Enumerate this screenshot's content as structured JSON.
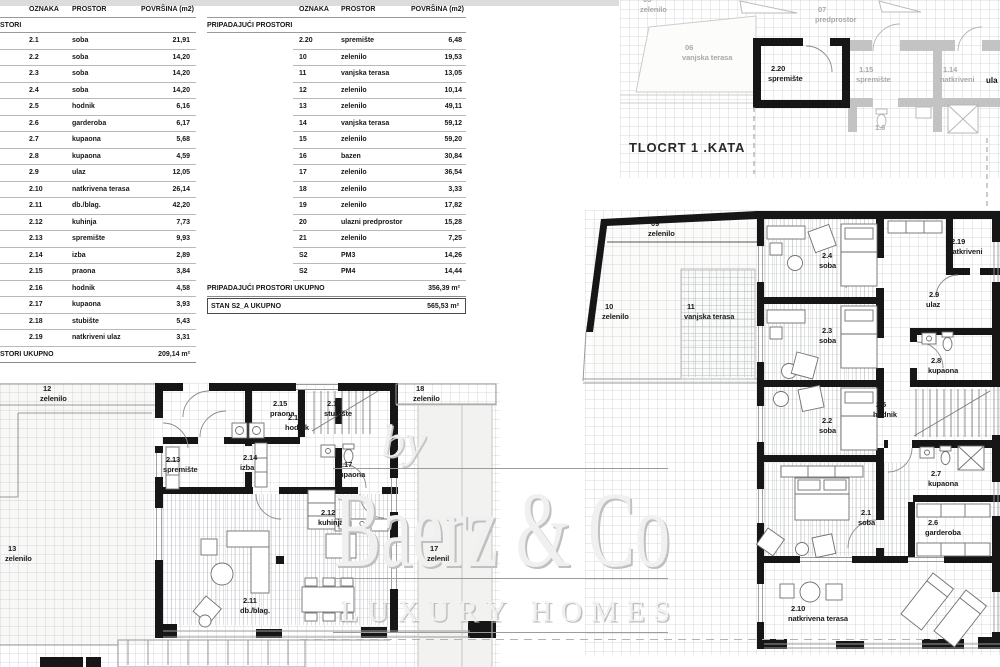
{
  "tables": {
    "columns": [
      "OZNAKA",
      "PROSTOR",
      "POVRŠINA (m2)"
    ],
    "table1": {
      "section": "STORI",
      "rows": [
        {
          "oznaka": "2.1",
          "prostor": "soba",
          "povrsina": "21,91"
        },
        {
          "oznaka": "2.2",
          "prostor": "soba",
          "povrsina": "14,20"
        },
        {
          "oznaka": "2.3",
          "prostor": "soba",
          "povrsina": "14,20"
        },
        {
          "oznaka": "2.4",
          "prostor": "soba",
          "povrsina": "14,20"
        },
        {
          "oznaka": "2.5",
          "prostor": "hodnik",
          "povrsina": "6,16"
        },
        {
          "oznaka": "2.6",
          "prostor": "garderoba",
          "povrsina": "6,17"
        },
        {
          "oznaka": "2.7",
          "prostor": "kupaona",
          "povrsina": "5,68"
        },
        {
          "oznaka": "2.8",
          "prostor": "kupaona",
          "povrsina": "4,59"
        },
        {
          "oznaka": "2.9",
          "prostor": "ulaz",
          "povrsina": "12,05"
        },
        {
          "oznaka": "2.10",
          "prostor": "natkrivena terasa",
          "povrsina": "26,14"
        },
        {
          "oznaka": "2.11",
          "prostor": "db./blag.",
          "povrsina": "42,20"
        },
        {
          "oznaka": "2.12",
          "prostor": "kuhinja",
          "povrsina": "7,73"
        },
        {
          "oznaka": "2.13",
          "prostor": "spremište",
          "povrsina": "9,93"
        },
        {
          "oznaka": "2.14",
          "prostor": "izba",
          "povrsina": "2,89"
        },
        {
          "oznaka": "2.15",
          "prostor": "praona",
          "povrsina": "3,84"
        },
        {
          "oznaka": "2.16",
          "prostor": "hodnik",
          "povrsina": "4,58"
        },
        {
          "oznaka": "2.17",
          "prostor": "kupaona",
          "povrsina": "3,93"
        },
        {
          "oznaka": "2.18",
          "prostor": "stubište",
          "povrsina": "5,43"
        },
        {
          "oznaka": "2.19",
          "prostor": "natkriveni ulaz",
          "povrsina": "3,31"
        }
      ],
      "footer": {
        "label": "STORI UKUPNO",
        "value": "209,14 m²"
      }
    },
    "table2": {
      "section": "PRIPADAJUĆI PROSTORI",
      "rows": [
        {
          "oznaka": "2.20",
          "prostor": "spremište",
          "povrsina": "6,48"
        },
        {
          "oznaka": "10",
          "prostor": "zelenilo",
          "povrsina": "19,53"
        },
        {
          "oznaka": "11",
          "prostor": "vanjska terasa",
          "povrsina": "13,05"
        },
        {
          "oznaka": "12",
          "prostor": "zelenilo",
          "povrsina": "10,14"
        },
        {
          "oznaka": "13",
          "prostor": "zelenilo",
          "povrsina": "49,11"
        },
        {
          "oznaka": "14",
          "prostor": "vanjska terasa",
          "povrsina": "59,12"
        },
        {
          "oznaka": "15",
          "prostor": "zelenilo",
          "povrsina": "59,20"
        },
        {
          "oznaka": "16",
          "prostor": "bazen",
          "povrsina": "30,84"
        },
        {
          "oznaka": "17",
          "prostor": "zelenilo",
          "povrsina": "36,54"
        },
        {
          "oznaka": "18",
          "prostor": "zelenilo",
          "povrsina": "3,33"
        },
        {
          "oznaka": "19",
          "prostor": "zelenilo",
          "povrsina": "17,82"
        },
        {
          "oznaka": "20",
          "prostor": "ulazni predprostor",
          "povrsina": "15,28"
        },
        {
          "oznaka": "21",
          "prostor": "zelenilo",
          "povrsina": "7,25"
        },
        {
          "oznaka": "S2",
          "prostor": "PM3",
          "povrsina": "14,26"
        },
        {
          "oznaka": "S2",
          "prostor": "PM4",
          "povrsina": "14,44"
        }
      ],
      "footer": {
        "label": "PRIPADAJUĆI PROSTORI UKUPNO",
        "value": "356,39 m²"
      },
      "total": {
        "label": "STAN S2_A UKUPNO",
        "value": "565,53 m²"
      }
    }
  },
  "plan": {
    "title": "TLOCRT 1 .KATA",
    "edge_label": "ula",
    "labels_black": [
      {
        "num": "2.20",
        "name": "spremište",
        "x": 768,
        "y": 64
      },
      {
        "num": "09",
        "name": "zelenilo",
        "x": 648,
        "y": 219
      },
      {
        "num": "10",
        "name": "zelenilo",
        "x": 602,
        "y": 302
      },
      {
        "num": "11",
        "name": "vanjska terasa",
        "x": 684,
        "y": 302
      },
      {
        "num": "2.4",
        "name": "soba",
        "x": 819,
        "y": 251
      },
      {
        "num": "2.19",
        "name": "natkriveni",
        "x": 948,
        "y": 237
      },
      {
        "num": "2.9",
        "name": "ulaz",
        "x": 926,
        "y": 290
      },
      {
        "num": "2.3",
        "name": "soba",
        "x": 819,
        "y": 326
      },
      {
        "num": "2.8",
        "name": "kupaona",
        "x": 928,
        "y": 356
      },
      {
        "num": "2.2",
        "name": "soba",
        "x": 819,
        "y": 416
      },
      {
        "num": "2.5",
        "name": "hodnik",
        "x": 873,
        "y": 400
      },
      {
        "num": "2.7",
        "name": "kupaona",
        "x": 928,
        "y": 469
      },
      {
        "num": "2.1",
        "name": "soba",
        "x": 858,
        "y": 508
      },
      {
        "num": "2.6",
        "name": "garderoba",
        "x": 925,
        "y": 518
      },
      {
        "num": "2.10",
        "name": "natkrivena terasa",
        "x": 788,
        "y": 604
      },
      {
        "num": "12",
        "name": "zelenilo",
        "x": 40,
        "y": 384
      },
      {
        "num": "18",
        "name": "zelenilo",
        "x": 413,
        "y": 384
      },
      {
        "num": "2.15",
        "name": "praona",
        "x": 270,
        "y": 399
      },
      {
        "num": "2.16",
        "name": "hodnik",
        "x": 285,
        "y": 413
      },
      {
        "num": "2.18",
        "name": "stubište",
        "x": 324,
        "y": 399
      },
      {
        "num": "2.13",
        "name": "spremište",
        "x": 163,
        "y": 455
      },
      {
        "num": "2.14",
        "name": "izba",
        "x": 240,
        "y": 453
      },
      {
        "num": "2.17",
        "name": "kupaona",
        "x": 335,
        "y": 460
      },
      {
        "num": "2.12",
        "name": "kuhinja",
        "x": 318,
        "y": 508
      },
      {
        "num": "13",
        "name": "zelenilo",
        "x": 5,
        "y": 544
      },
      {
        "num": "2.11",
        "name": "db./blag.",
        "x": 240,
        "y": 596
      },
      {
        "num": "17",
        "name": "zelenilo",
        "x": 427,
        "y": 544
      }
    ],
    "labels_gray": [
      {
        "num": "05",
        "name": "zelenilo",
        "x": 640,
        "y": -5
      },
      {
        "num": "06",
        "name": "vanjska terasa",
        "x": 682,
        "y": 43
      },
      {
        "num": "07",
        "name": "predprostor",
        "x": 815,
        "y": 5
      },
      {
        "num": "1.15",
        "name": "spremište",
        "x": 856,
        "y": 65
      },
      {
        "num": "1.14",
        "name": "natkriveni",
        "x": 940,
        "y": 65
      },
      {
        "num": "1.6",
        "x": 872,
        "y": 123
      }
    ]
  },
  "watermark": {
    "by": "by",
    "name": "Baerz & Co",
    "tagline": "LUXURY HOMES"
  }
}
